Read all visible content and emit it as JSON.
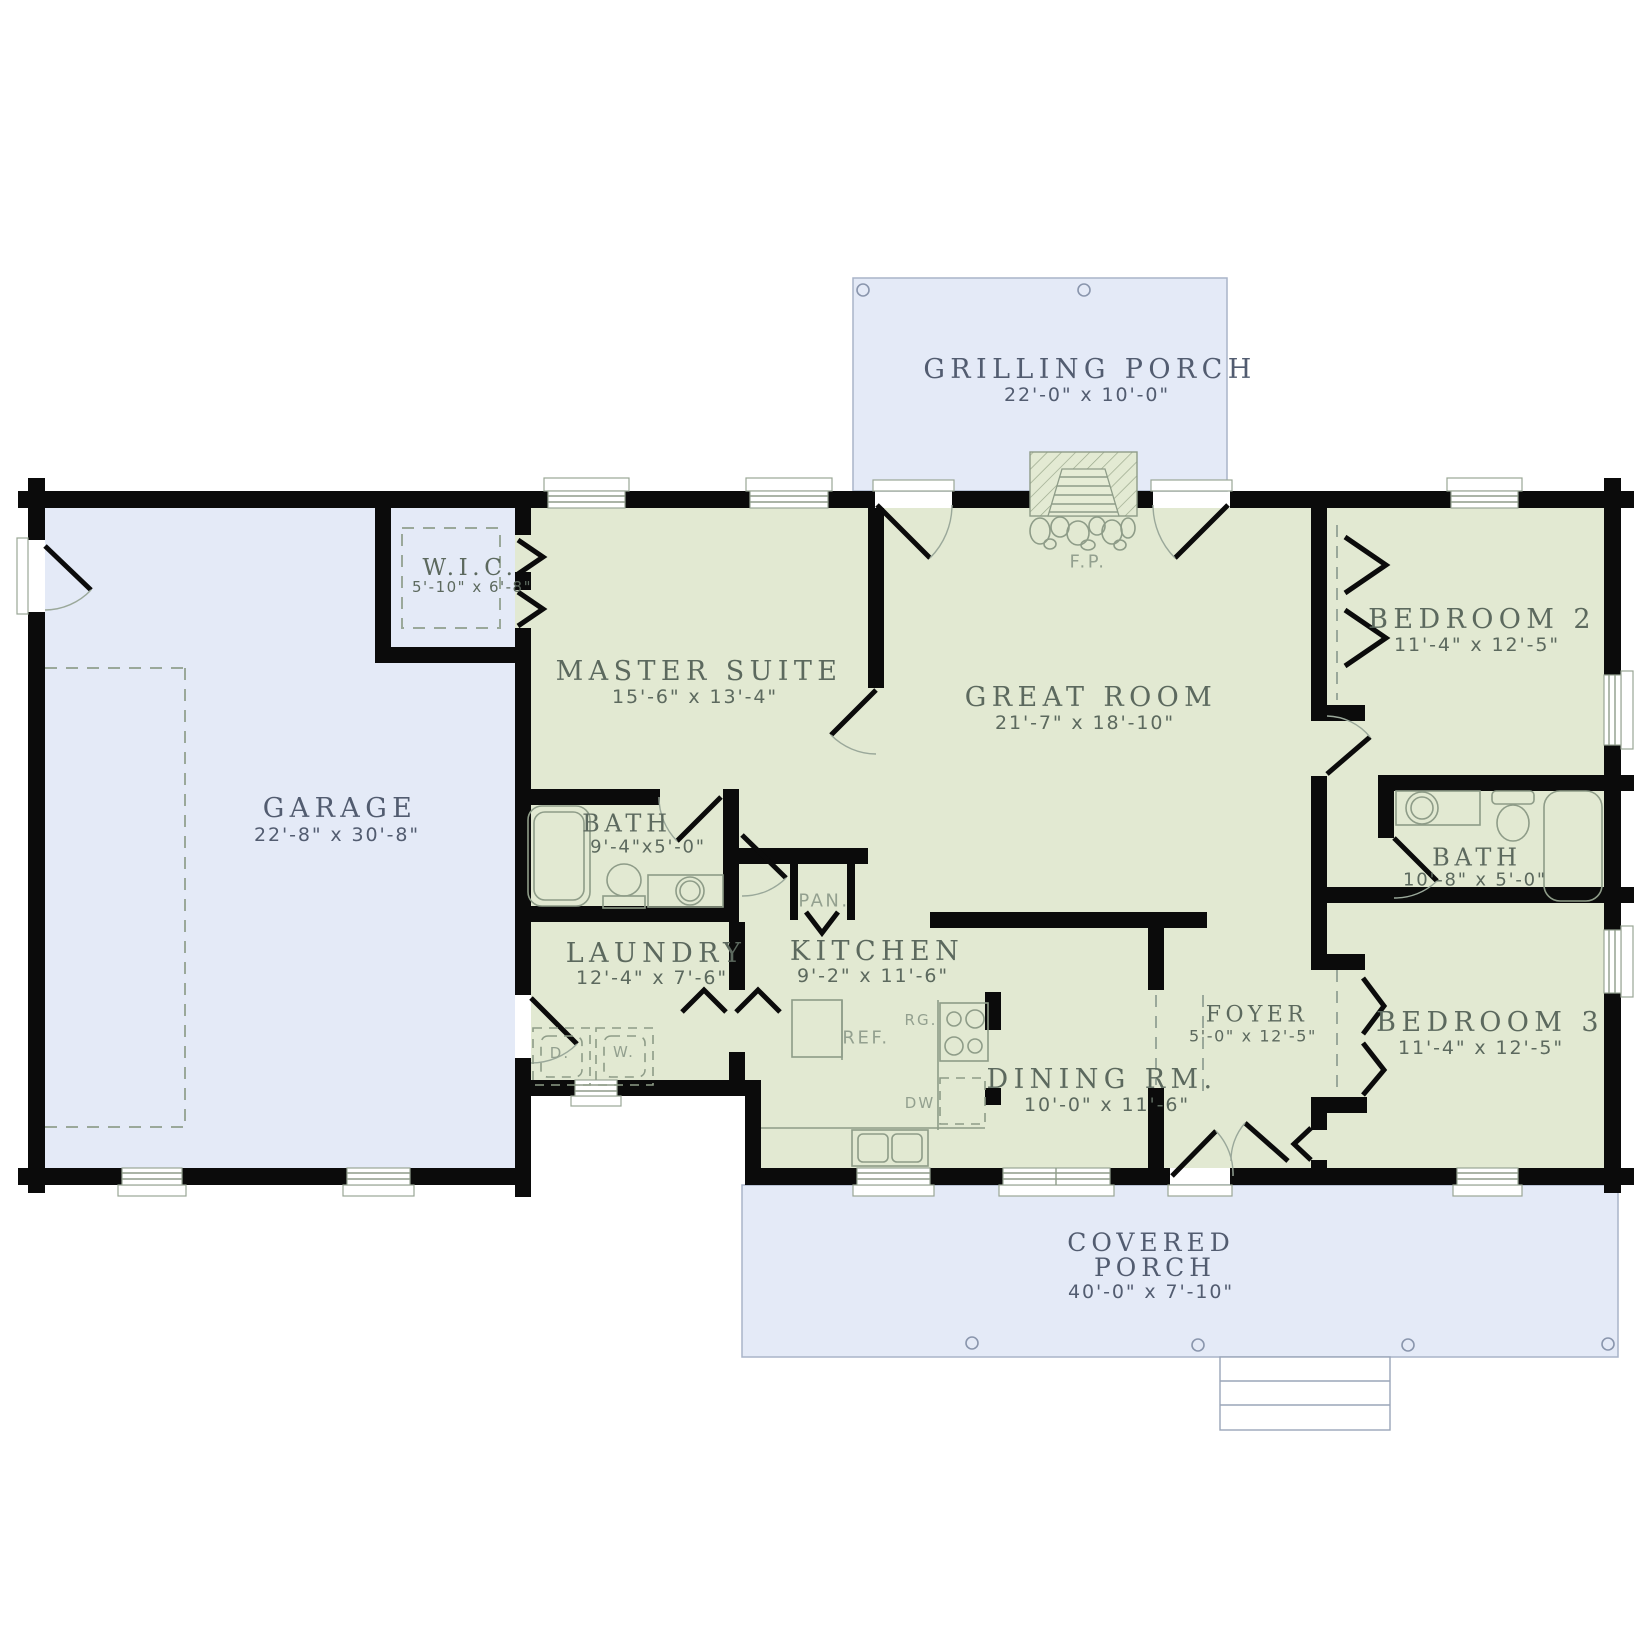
{
  "plan": {
    "colors": {
      "wall": "#0b0b0b",
      "interior": "#e2e9d2",
      "porch": "#e4eaf7",
      "porch-line": "#a9b4c9",
      "fixture": "#8e9c88",
      "label-green": "#5c695e",
      "label-blue": "#525c70",
      "fixture-label": "#93a08f"
    },
    "rooms": {
      "grilling_porch": {
        "name": "GRILLING PORCH",
        "dims": "22'-0\" x 10'-0\""
      },
      "garage": {
        "name": "GARAGE",
        "dims": "22'-8\" x 30'-8\""
      },
      "wic": {
        "name": "W.I.C.",
        "dims": "5'-10\" x 6'-8\""
      },
      "master_suite": {
        "name": "MASTER SUITE",
        "dims": "15'-6\" x 13'-4\""
      },
      "great_room": {
        "name": "GREAT ROOM",
        "dims": "21'-7\" x 18'-10\""
      },
      "bedroom2": {
        "name": "BEDROOM 2",
        "dims": "11'-4\" x 12'-5\""
      },
      "bath1": {
        "name": "BATH",
        "dims": "9'-4\"x5'-0\""
      },
      "bath2": {
        "name": "BATH",
        "dims": "10'-8\" x 5'-0\""
      },
      "laundry": {
        "name": "LAUNDRY",
        "dims": "12'-4\" x 7'-6\""
      },
      "kitchen": {
        "name": "KITCHEN",
        "dims": "9'-2\" x 11'-6\""
      },
      "dining": {
        "name": "DINING RM.",
        "dims": "10'-0\" x 11'-6\""
      },
      "foyer": {
        "name": "FOYER",
        "dims": "5'-0\" x 12'-5\""
      },
      "bedroom3": {
        "name": "BEDROOM 3",
        "dims": "11'-4\" x 12'-5\""
      },
      "covered_porch": {
        "name_line1": "COVERED",
        "name_line2": "PORCH",
        "dims": "40'-0\" x 7'-10\""
      }
    },
    "fixtures": {
      "fireplace": "F.P.",
      "pantry": "PAN.",
      "refrigerator": "REF.",
      "range": "RG.",
      "dishwasher": "DW",
      "dryer": "D.",
      "washer": "W."
    }
  }
}
